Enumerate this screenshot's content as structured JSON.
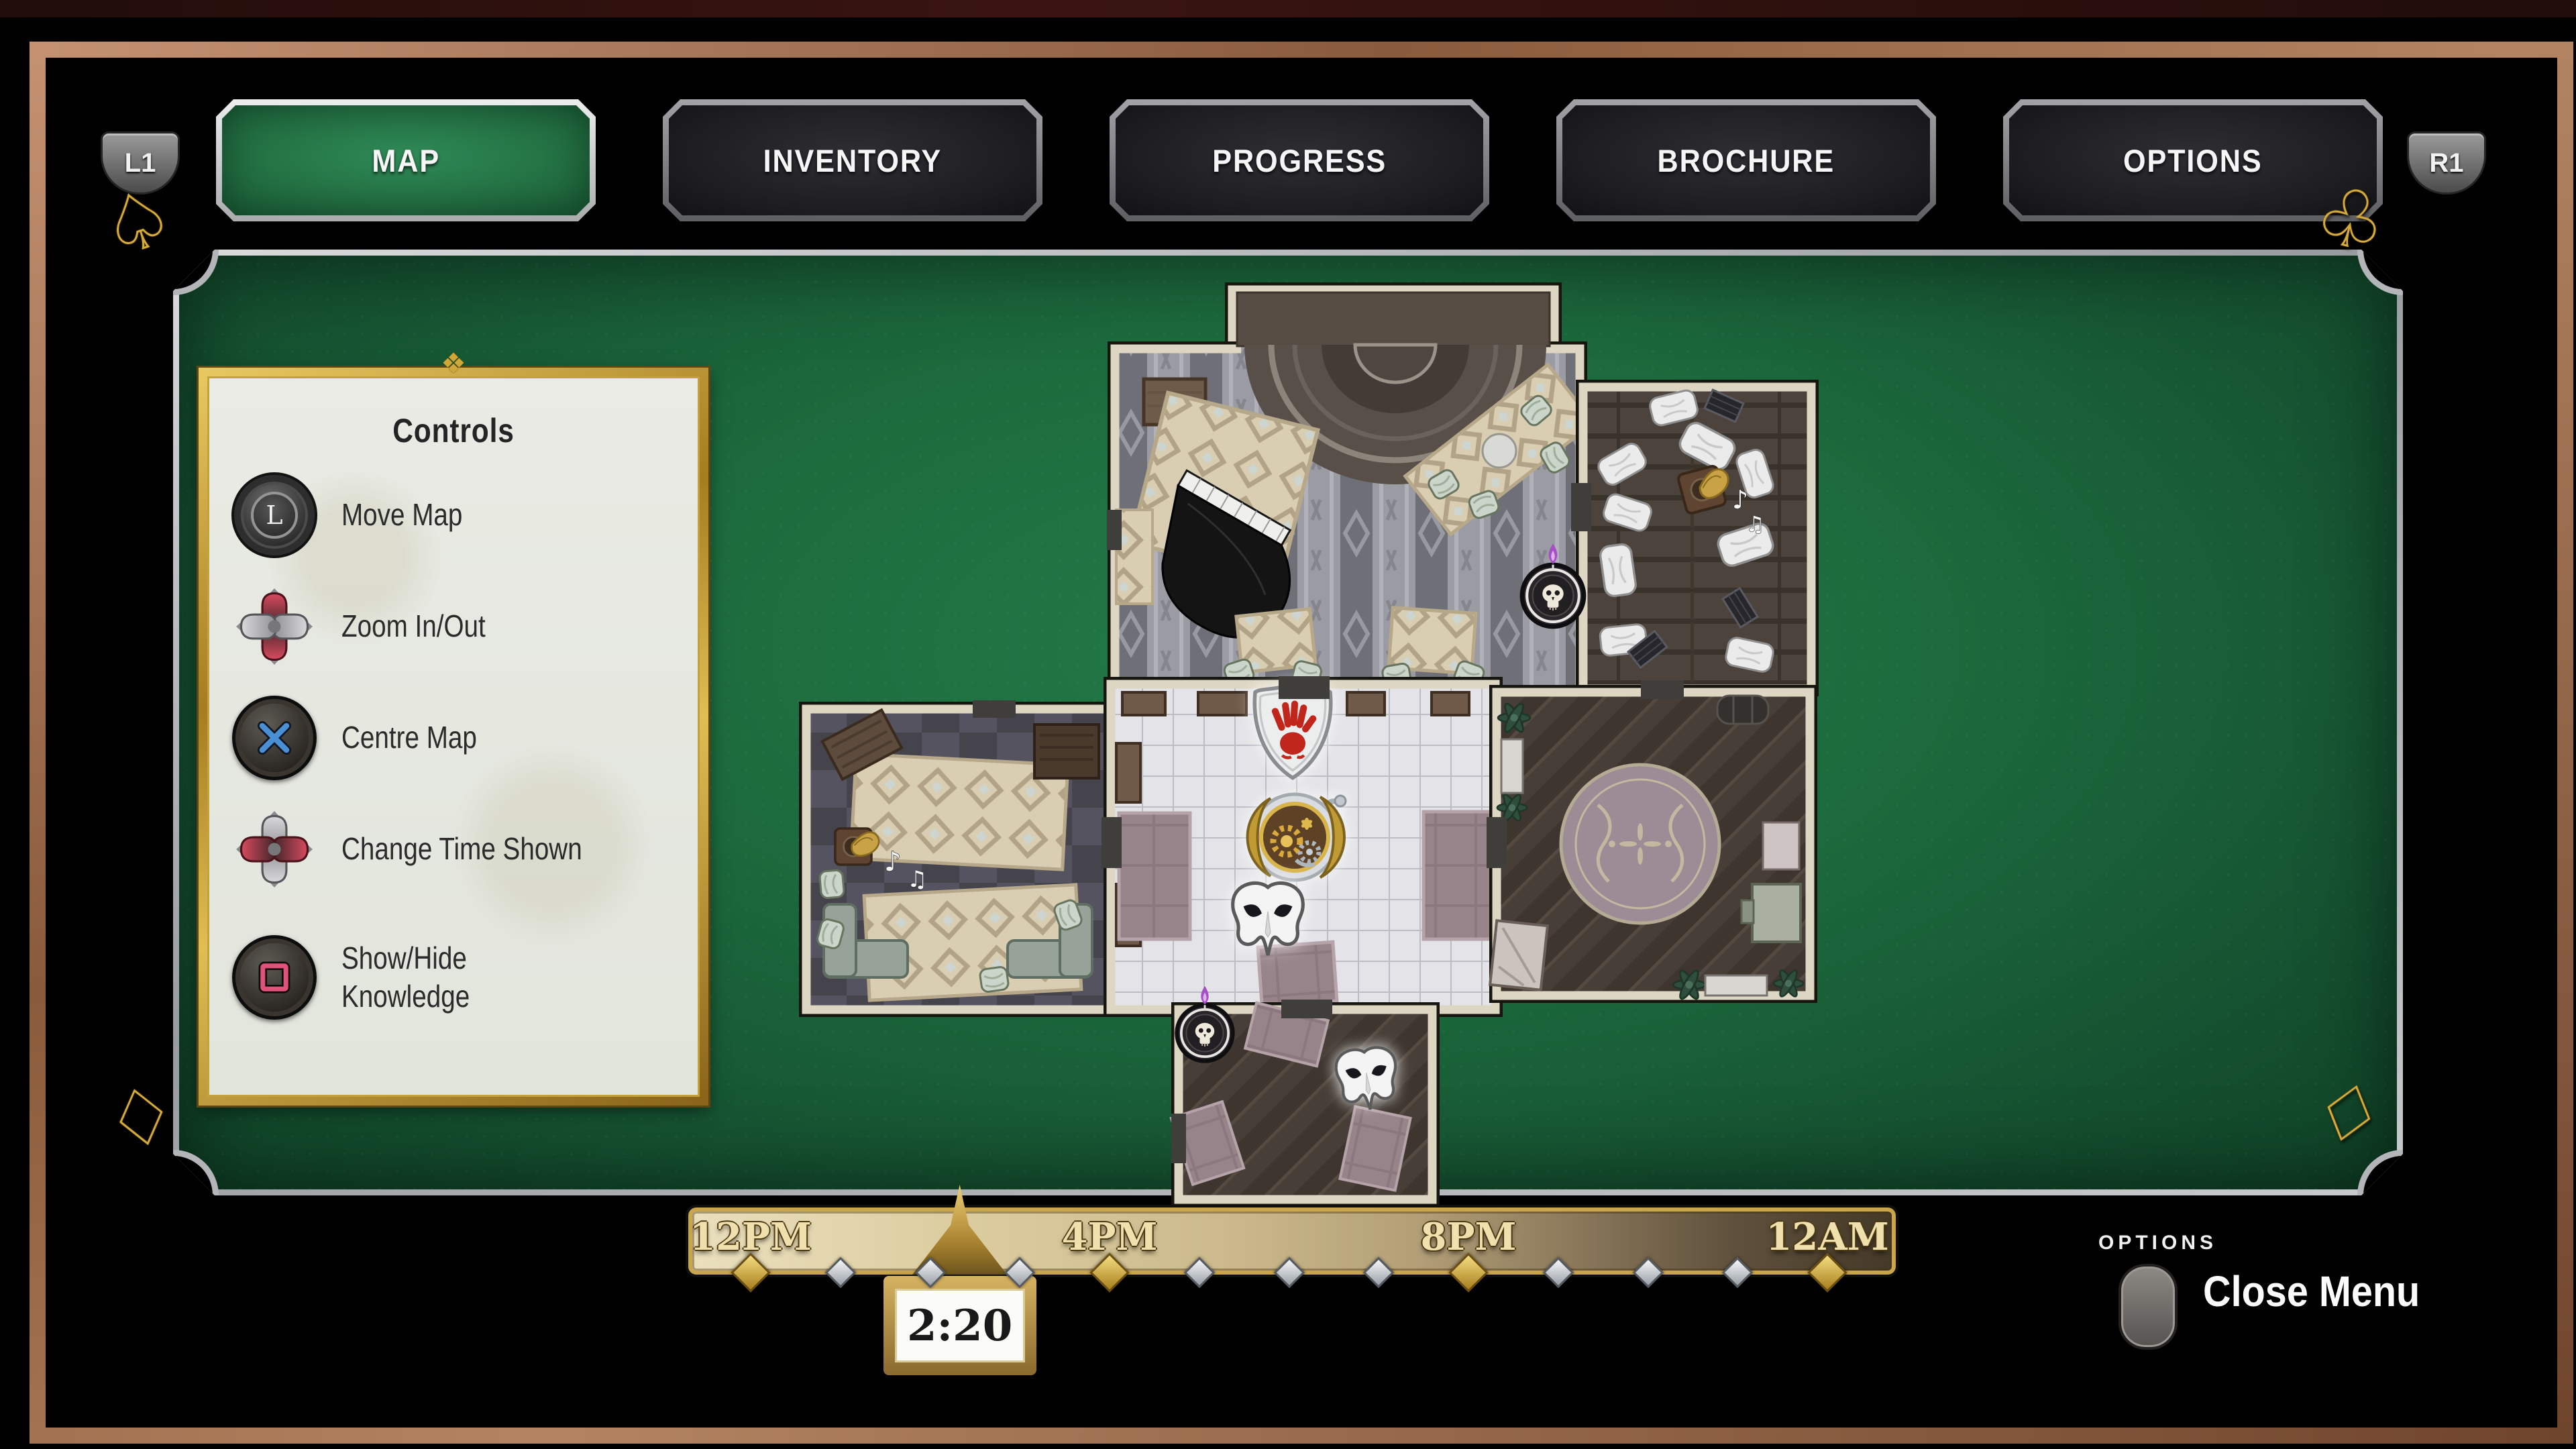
{
  "tab_bar": {
    "left_shoulder": "L1",
    "right_shoulder": "R1",
    "tabs": [
      {
        "label": "MAP",
        "active": true
      },
      {
        "label": "INVENTORY",
        "active": false
      },
      {
        "label": "PROGRESS",
        "active": false
      },
      {
        "label": "BROCHURE",
        "active": false
      },
      {
        "label": "OPTIONS",
        "active": false
      }
    ]
  },
  "controls_panel": {
    "title": "Controls",
    "items": [
      {
        "icon": "left-stick-icon",
        "button": "L",
        "label": "Move Map"
      },
      {
        "icon": "dpad-up-down-icon",
        "label": "Zoom In/Out"
      },
      {
        "icon": "cross-button-icon",
        "label": "Centre Map"
      },
      {
        "icon": "dpad-left-right-icon",
        "label": "Change Time Shown"
      },
      {
        "icon": "square-button-icon",
        "label": "Show/Hide Knowledge"
      }
    ]
  },
  "timeline": {
    "tick_labels": [
      "12PM",
      "4PM",
      "8PM",
      "12AM"
    ],
    "label_hours": [
      0,
      4,
      8,
      12
    ],
    "total_hours": 12,
    "hour_marks": 13,
    "major_every": 4,
    "current_time": "2:20",
    "current_hour_fraction": 2.33
  },
  "footer": {
    "options_button_label": "OPTIONS",
    "close_menu_label": "Close Menu"
  },
  "map": {
    "rooms": [
      "ballroom",
      "storage-room",
      "left-lounge",
      "central-hall",
      "round-rug-room",
      "bottom-corridor"
    ],
    "markers": [
      "blood-hand-shield",
      "pocket-watch",
      "white-mask-central",
      "white-mask-corridor",
      "skull-candle-ballroom",
      "skull-candle-corridor",
      "grand-piano",
      "gramophone-left-lounge",
      "gramophone-storage"
    ]
  },
  "colors": {
    "felt_green": "#1c6a3d",
    "tab_green": "#247345",
    "gold": "#c9a54e",
    "copper_frame": "#a57248",
    "paper": "#e9ebe4",
    "map_wall": "#ddd6c2",
    "hand_red": "#c1261c",
    "dpad_red": "#c94052",
    "cross_blue": "#4a8fd4",
    "square_pink": "#e0527a",
    "flame_purple": "#a54fc6"
  }
}
